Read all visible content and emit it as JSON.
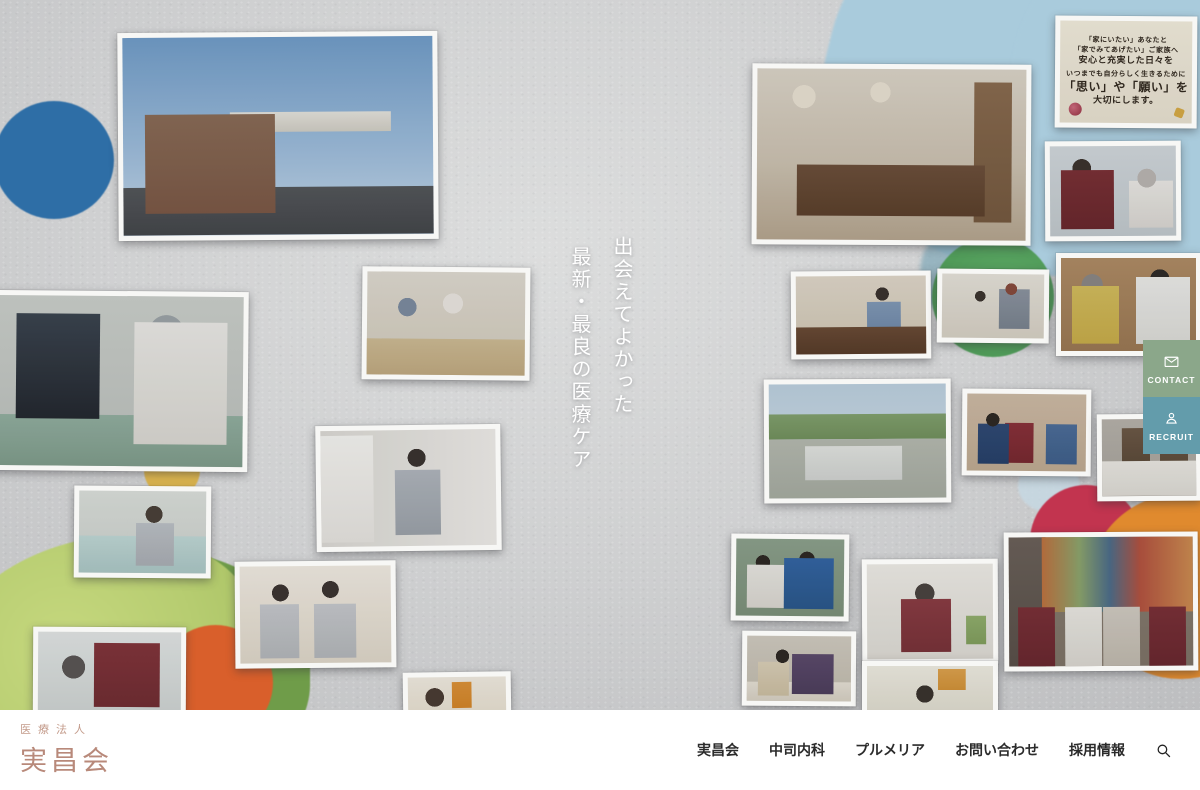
{
  "hero": {
    "headline": [
      "出会えてよかった",
      "最新・最良の医療ケア"
    ]
  },
  "side_buttons": {
    "contact_label": "CONTACT",
    "contact_icon": "envelope-icon",
    "recruit_label": "RECRUIT",
    "recruit_icon": "person-icon"
  },
  "calligraphy": {
    "lines": [
      "「家にいたい」あなたと",
      "「家でみてあげたい」ご家族へ",
      "安心と充実した日々を",
      "いつまでも自分らしく生きるために",
      "「思い」や「願い」を",
      "大切にします。"
    ]
  },
  "footer": {
    "logo_small": "医療法人",
    "logo_large": "実昌会",
    "nav": [
      "実昌会",
      "中司内科",
      "プルメリア",
      "お問い合わせ",
      "採用情報"
    ],
    "search_icon": "magnifier-icon"
  },
  "colors": {
    "contact_button": "#8ba78a",
    "recruit_button": "#639cab",
    "logo_text": "#b8897a",
    "nav_text": "#2b2b2b",
    "wall": "#cfd0d1"
  }
}
